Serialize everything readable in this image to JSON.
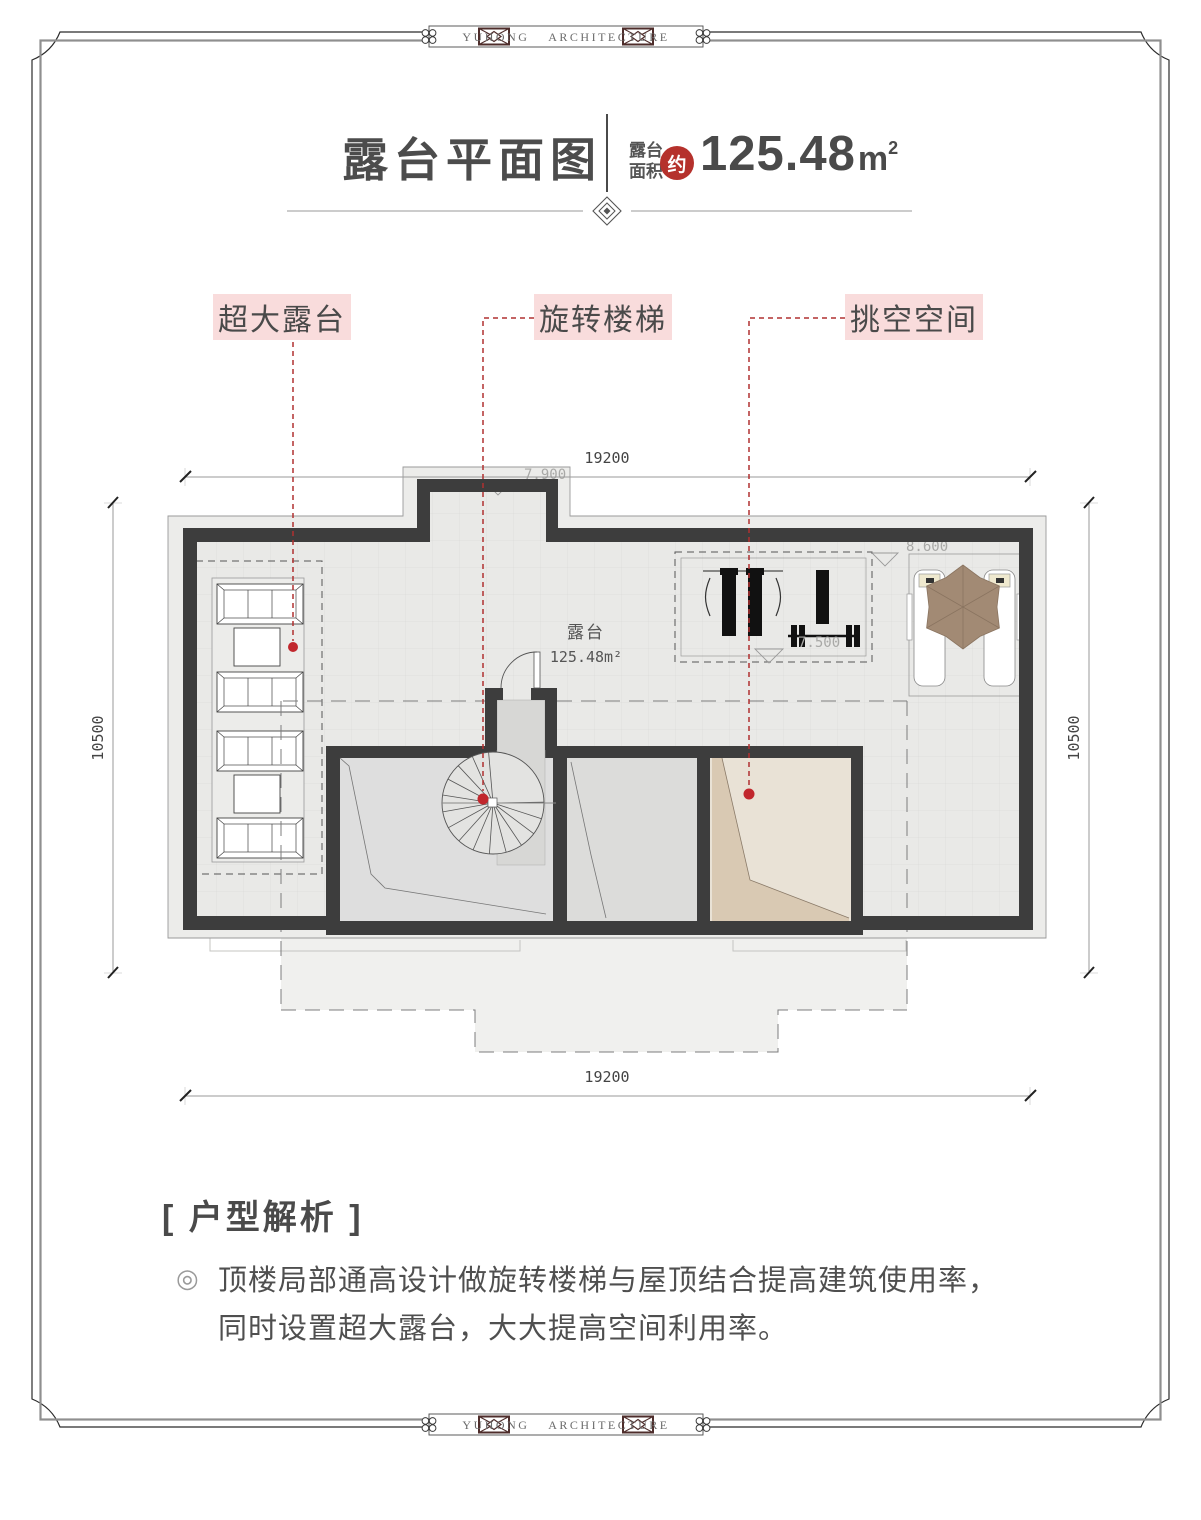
{
  "brand": {
    "text": "YUHONG ARCHITECTURE"
  },
  "header": {
    "title": "露台平面图",
    "area_label_top": "露台",
    "area_label_bottom": "面积",
    "seal": "约",
    "area_value": "125.48",
    "area_unit": "m",
    "area_exp": "2"
  },
  "callouts": {
    "terrace": "超大露台",
    "stairs": "旋转楼梯",
    "void": "挑空空间"
  },
  "plan": {
    "room_name": "露台",
    "room_area": "125.48m²",
    "dim_top": "19200",
    "dim_bottom": "19200",
    "dim_left": "10500",
    "dim_right": "10500",
    "level_top": "7.900",
    "level_gym": "7.500",
    "level_right": "8.600"
  },
  "analysis": {
    "title": "[ 户型解析 ]",
    "bullet": "◎",
    "line1": "顶楼局部通高设计做旋转楼梯与屋顶结合提高建筑使用率，",
    "line2": "同时设置超大露台，大大提高空间利用率。"
  },
  "colors": {
    "accent_red": "#b5312c",
    "label_pink": "#f9dcdc",
    "wall_dark": "#3d3d3d",
    "leader_red": "#b03030"
  }
}
